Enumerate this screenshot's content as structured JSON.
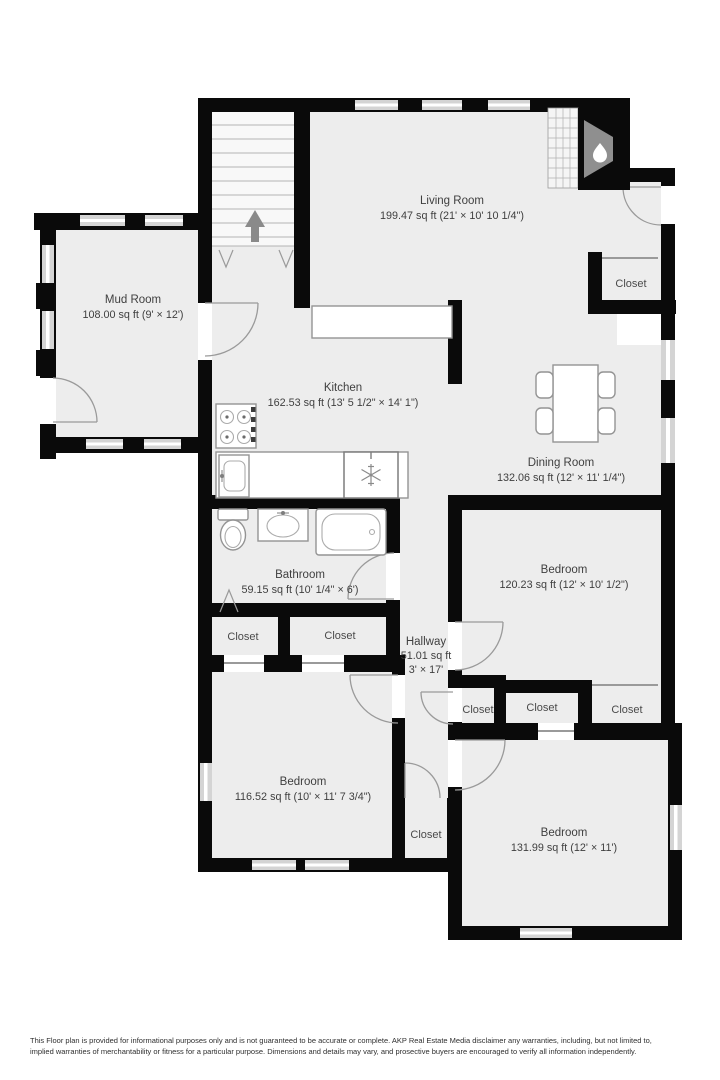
{
  "title": "Floor Plan",
  "rooms": {
    "living_room": {
      "name": "Living Room",
      "area": "199.47 sq ft (21' × 10' 10 1/4\")"
    },
    "mud_room": {
      "name": "Mud Room",
      "area": "108.00 sq ft (9' × 12')"
    },
    "kitchen": {
      "name": "Kitchen",
      "area": "162.53 sq ft (13' 5 1/2\" × 14' 1\")"
    },
    "dining_room": {
      "name": "Dining Room",
      "area": "132.06 sq ft (12' × 11' 1/4\")"
    },
    "bathroom": {
      "name": "Bathroom",
      "area": "59.15 sq ft (10' 1/4\" × 6')"
    },
    "hallway": {
      "name": "Hallway",
      "area": "51.01 sq ft",
      "dims": "3' × 17'"
    },
    "bedroom_middle": {
      "name": "Bedroom",
      "area": "120.23 sq ft (12' × 10' 1/2\")"
    },
    "bedroom_bottom_left": {
      "name": "Bedroom",
      "area": "116.52 sq ft (10' × 11' 7 3/4\")"
    },
    "bedroom_bottom_right": {
      "name": "Bedroom",
      "area": "131.99 sq ft (12' × 11')"
    }
  },
  "closets": {
    "top_right": "Closet",
    "bath_left": "Closet",
    "bath_right": "Closet",
    "hall_left": "Closet",
    "hall_middle": "Closet",
    "hall_right": "Closet",
    "bottom_middle": "Closet"
  },
  "fixtures": [
    "staircase-up-arrow",
    "fireplace-flame",
    "dining-table-four-chairs",
    "stove-four-burners",
    "kitchen-sink",
    "refrigerator-snowflake",
    "kitchen-counter",
    "toilet",
    "bathroom-sink",
    "bathtub"
  ],
  "colors": {
    "wall": "#0a0a0a",
    "floor": "#ededed",
    "window": "#d4d4d4",
    "fixture_stroke": "#949494",
    "arrow_gray": "#8a8a8a",
    "label_text": "#3f3f3f"
  },
  "footer": {
    "disclaimer": "This Floor plan is provided for informational purposes only and is not guaranteed to be accurate or complete. AKP Real Estate Media disclaimer any warranties, including, but not limited to, implied warranties of merchantability or fitness for a particular purpose. Dimensions and details may vary, and prosective buyers are encouraged to verify all information independently."
  }
}
